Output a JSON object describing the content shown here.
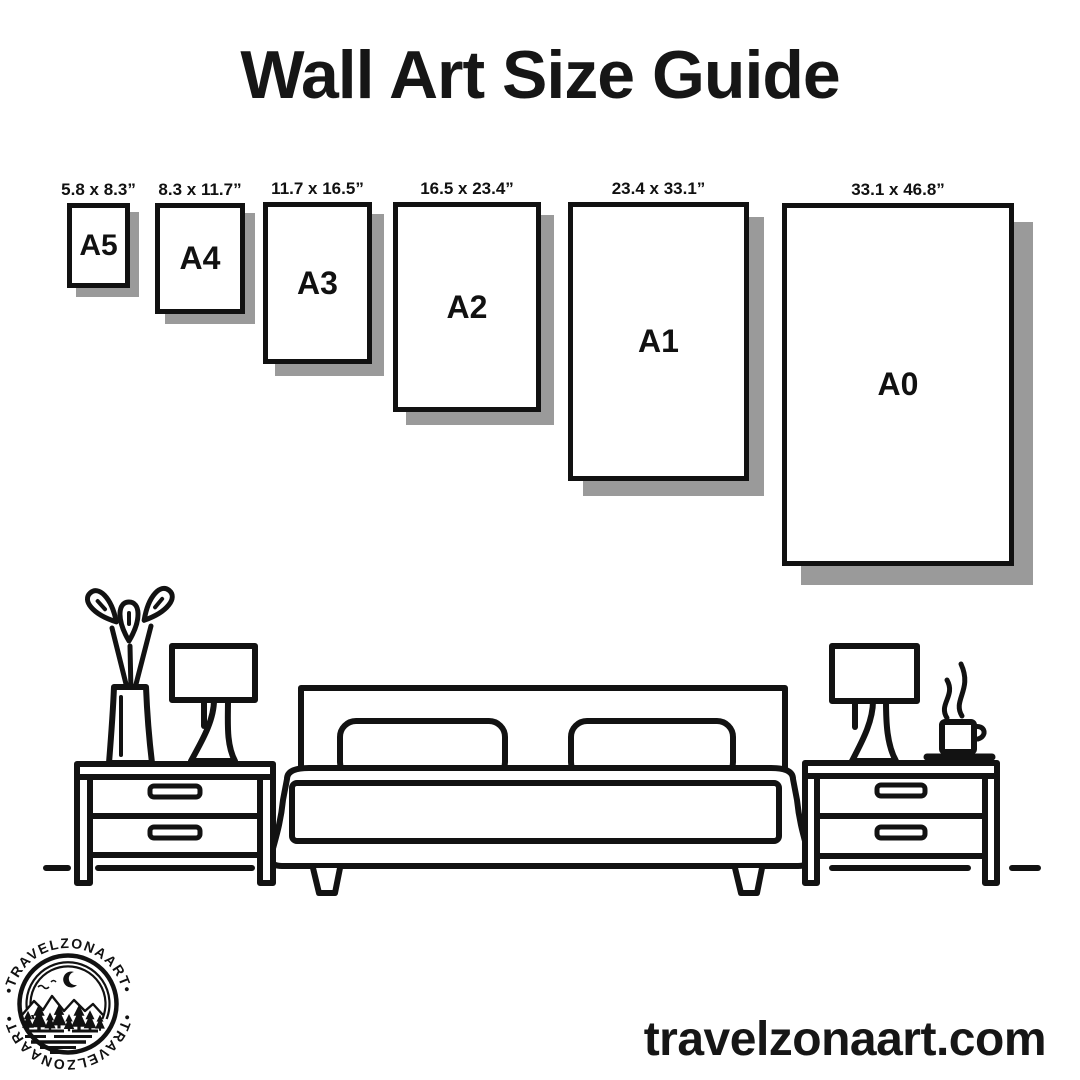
{
  "title": "Wall Art Size Guide",
  "papers": [
    {
      "id": "a5",
      "name": "A5",
      "dims": "5.8 x 8.3”"
    },
    {
      "id": "a4",
      "name": "A4",
      "dims": "8.3 x 11.7”"
    },
    {
      "id": "a3",
      "name": "A3",
      "dims": "11.7 x 16.5”"
    },
    {
      "id": "a2",
      "name": "A2",
      "dims": "16.5 x 23.4”"
    },
    {
      "id": "a1",
      "name": "A1",
      "dims": "23.4 x 33.1”"
    },
    {
      "id": "a0",
      "name": "A0",
      "dims": "33.1 x 46.8”"
    }
  ],
  "logo": {
    "brand": "TRAVELZONAART",
    "arc_text_top": "•TRAVELZONAART•",
    "arc_text_bottom": "•TRAVELZONAART•"
  },
  "footer": {
    "website": "travelzonaart.com"
  },
  "illustration": {
    "items": [
      "plant-vase",
      "table-lamp-left",
      "nightstand-left",
      "double-bed",
      "pillow",
      "pillow",
      "nightstand-right",
      "table-lamp-right",
      "coffee-cup",
      "floor-line"
    ]
  },
  "colors": {
    "ink": "#111111",
    "paper_shadow": "#9a9a9a",
    "background": "#ffffff"
  }
}
